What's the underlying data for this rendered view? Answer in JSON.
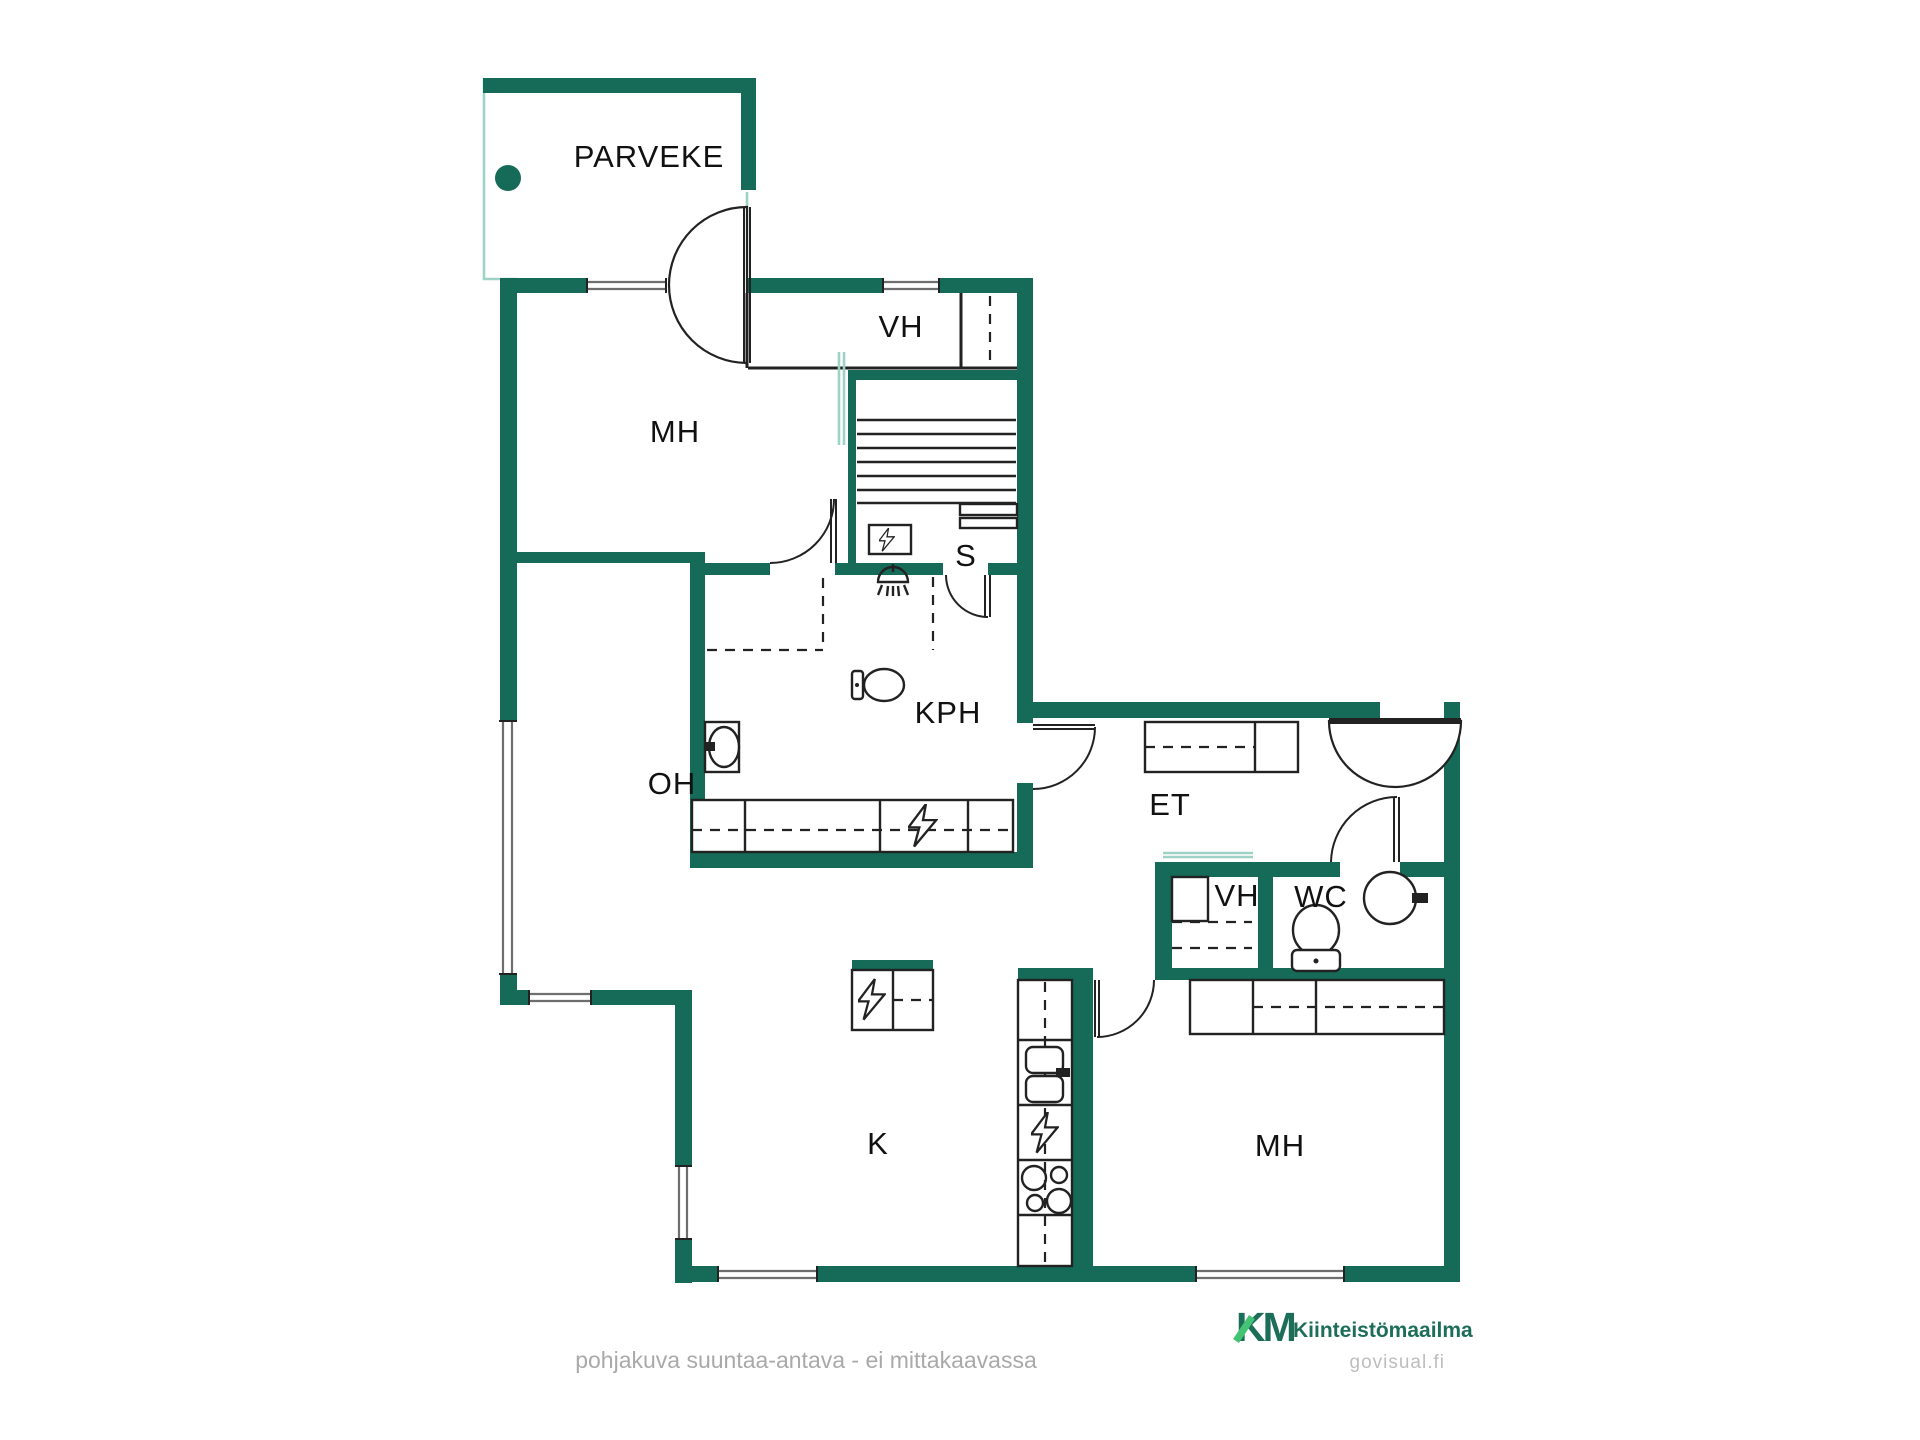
{
  "colors": {
    "wall": "#156a58",
    "glass_line": "#9fd2c6",
    "furniture_line": "#222222",
    "window_line": "#6e6e6e",
    "label_text": "#111111",
    "footer_text": "#a9a9a9",
    "logo_green": "#1d6e59",
    "logo_accent": "#45c374",
    "watermark_gray": "#bdbdbd"
  },
  "rooms": {
    "balcony": "PARVEKE",
    "bedroom_top": "MH",
    "closet_top": "VH",
    "sauna": "S",
    "bathroom": "KPH",
    "living_room": "OH",
    "entry_hall": "ET",
    "closet_hall": "VH",
    "wc": "WC",
    "kitchen": "K",
    "bedroom_bottom": "MH"
  },
  "footer": {
    "disclaimer": "pohjakuva suuntaa-antava - ei mittakaavassa"
  },
  "branding": {
    "logo_initials": "KM",
    "logo_name": "Kiinteistömaailma",
    "watermark": "govisual.fi"
  }
}
